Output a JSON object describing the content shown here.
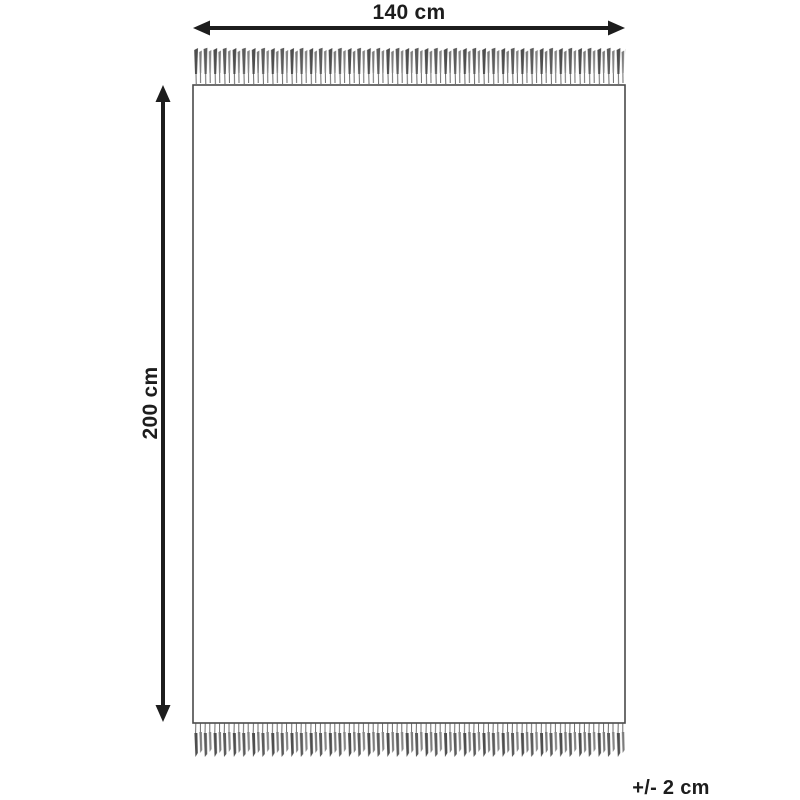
{
  "labels": {
    "width": "140 cm",
    "height": "200 cm",
    "tolerance": "+/- 2 cm"
  },
  "dimensions": {
    "width_cm": 140,
    "height_cm": 200,
    "tolerance_cm": 2
  },
  "icons": {
    "horizontal_arrow": "double-headed-dimension-arrow",
    "vertical_arrow": "double-headed-dimension-arrow",
    "fringe": "tassel-fringe"
  },
  "colors": {
    "arrow": "#1d1d1d",
    "rug_border": "#4a4a4a",
    "tassel_dark": "#4e4e4e",
    "tassel_light": "#7c7c7c",
    "background": "#ffffff"
  }
}
